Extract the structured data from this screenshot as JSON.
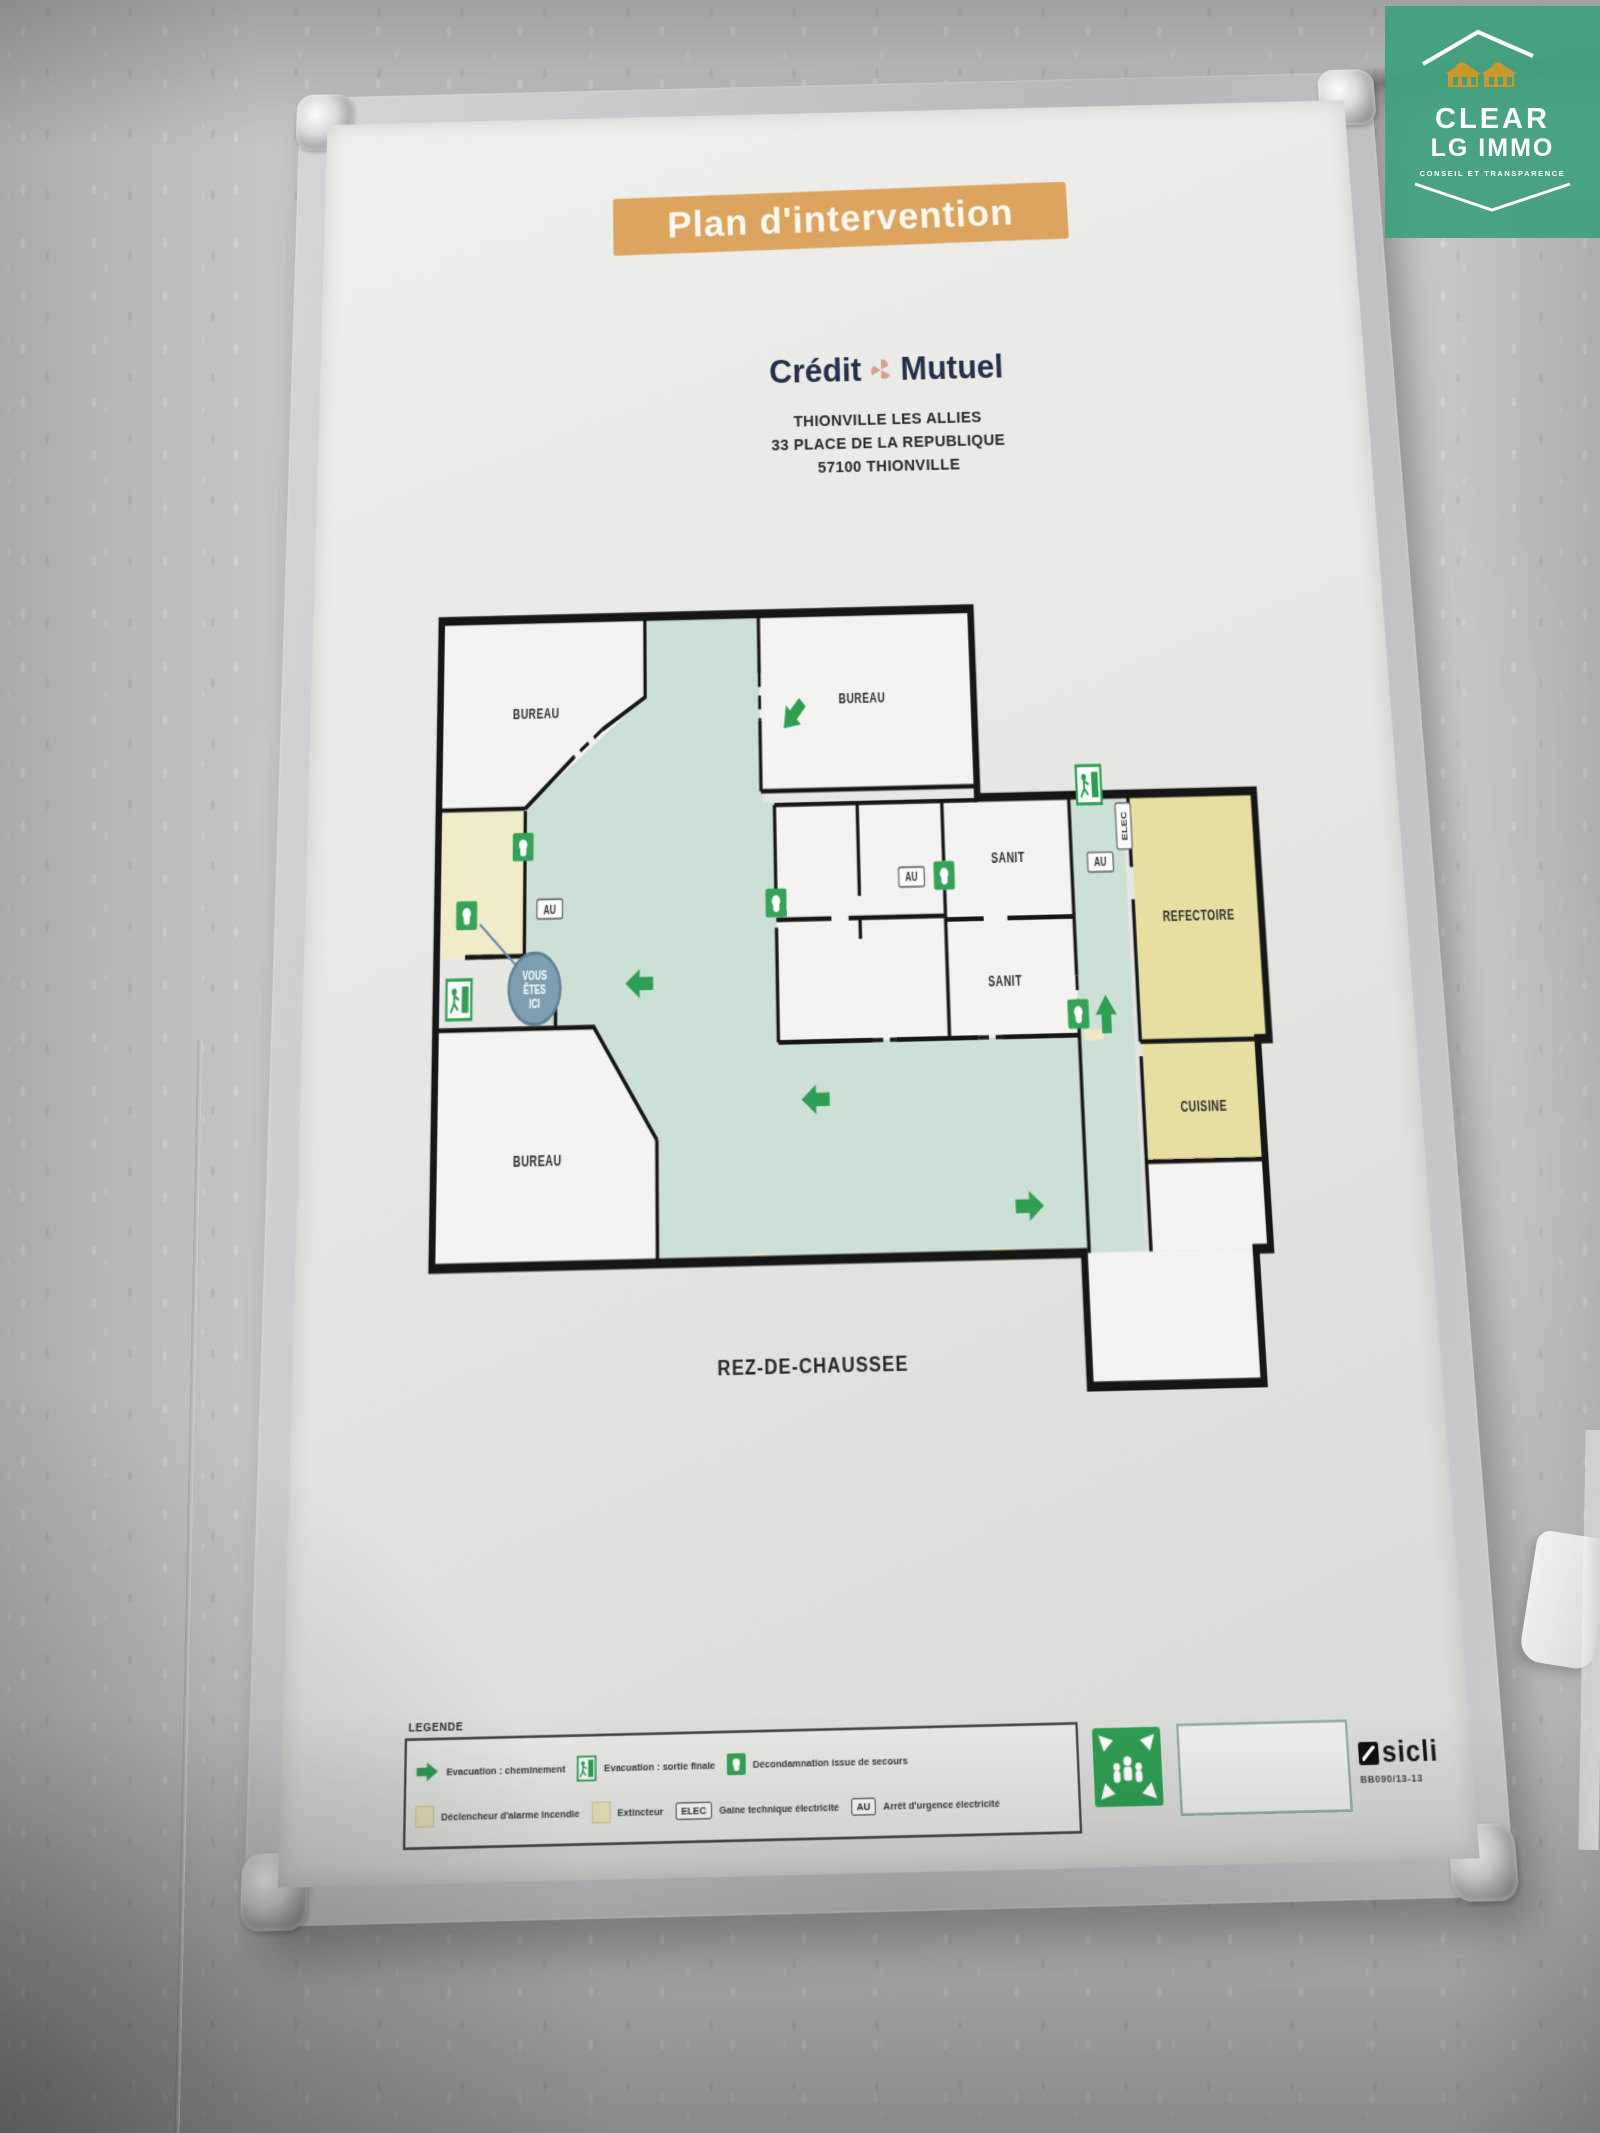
{
  "overlay_logo": {
    "brand": "CLEAR",
    "brand2": "LG IMMO",
    "tagline": "CONSEIL ET TRANSPARENCE"
  },
  "poster": {
    "title": "Plan d'intervention",
    "bank": {
      "left": "Crédit",
      "right": "Mutuel"
    },
    "address_lines": [
      "THIONVILLE LES ALLIES",
      "33 PLACE DE LA REPUBLIQUE",
      "57100 THIONVILLE"
    ],
    "floor_label": "REZ-DE-CHAUSSEE",
    "plan": {
      "rooms": {
        "bureau_tl": "BUREAU",
        "bureau_tr": "BUREAU",
        "sanit_1": "SANIT",
        "sanit_2": "SANIT",
        "refectoire": "REFECTOIRE",
        "cuisine": "CUISINE",
        "bureau_bl": "BUREAU"
      },
      "marker_you_are_here": {
        "line1": "VOUS",
        "line2": "ÊTES",
        "line3": "ICI"
      },
      "chip_au": "AU",
      "chip_elec": "ELEC"
    },
    "legend": {
      "title": "LEGENDE",
      "row1": [
        {
          "label": "Evacuation : cheminement"
        },
        {
          "label": "Evacuation : sortie finale"
        },
        {
          "label": "Décondamnation issue de secours"
        }
      ],
      "row2": [
        {
          "label": "Déclencheur d'alarme incendie"
        },
        {
          "label": "Extincteur"
        },
        {
          "chip": "ELEC",
          "label": "Gaine technique électricité"
        },
        {
          "chip": "AU",
          "label": "Arrêt d'urgence électricité"
        }
      ]
    },
    "publisher": {
      "brand": "sicli",
      "ref": "BB090/13-13"
    }
  },
  "colors": {
    "banner_orange": "#dca45f",
    "mint": "#cde0d6",
    "room_yellow": "#e7dfa2",
    "pale_yellow": "#f0ebc8",
    "safety_green": "#2f9e53",
    "navy": "#25304a",
    "logo_green": "#3fa07c",
    "gold": "#c9992e"
  }
}
